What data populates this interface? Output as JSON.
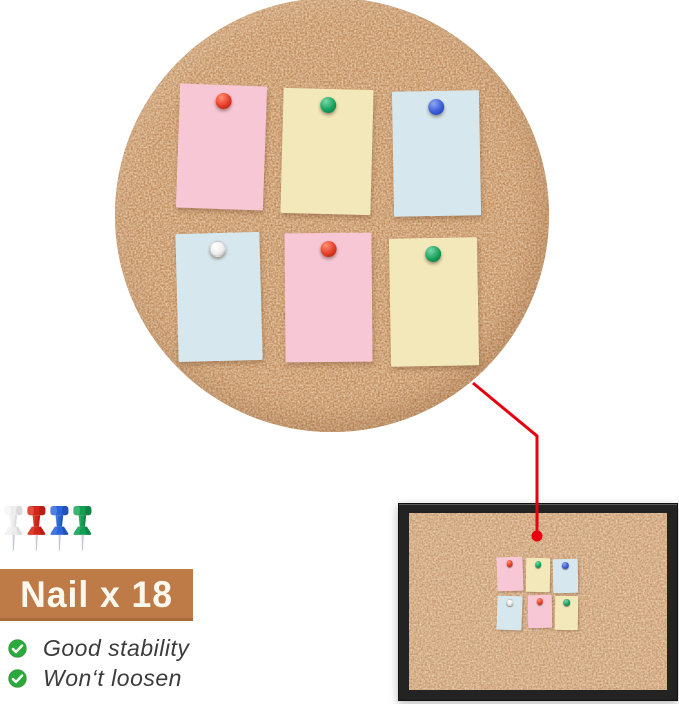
{
  "banner": {
    "label": "Nail x 18"
  },
  "checklist": {
    "items": [
      {
        "label": "Good stability"
      },
      {
        "label": "Won‘t loosen"
      }
    ]
  },
  "pushpin_samples": {
    "colors": [
      "white",
      "red",
      "blue",
      "green"
    ]
  },
  "boards": {
    "circle_closeup": {
      "notes": [
        {
          "paper": "pink",
          "pin": "red"
        },
        {
          "paper": "yellow",
          "pin": "green"
        },
        {
          "paper": "blue",
          "pin": "blue"
        },
        {
          "paper": "blue",
          "pin": "white"
        },
        {
          "paper": "pink",
          "pin": "red"
        },
        {
          "paper": "yellow",
          "pin": "green"
        }
      ]
    },
    "framed_board": {
      "notes": [
        {
          "paper": "pink",
          "pin": "red"
        },
        {
          "paper": "yellow",
          "pin": "green"
        },
        {
          "paper": "blue",
          "pin": "blue"
        },
        {
          "paper": "blue",
          "pin": "white"
        },
        {
          "paper": "pink",
          "pin": "red"
        },
        {
          "paper": "yellow",
          "pin": "green"
        }
      ]
    }
  },
  "colors": {
    "cork_base": "#BC8352",
    "cork_speckle_light": "#EDC28F",
    "note_pink": "#F8C7D5",
    "note_yellow": "#F2E8BA",
    "note_blue": "#D6E8EE",
    "pin_red": "#D8301F",
    "pin_green": "#17A05A",
    "pin_blue": "#3A5CD8",
    "pin_white": "#F0F0F0",
    "frame_black": "#232323",
    "banner_brown": "#BF7B47",
    "banner_text": "#FDF8EE",
    "callout_red": "#E8000F",
    "check_green": "#2CA93C",
    "feature_text": "#3B3B3B"
  }
}
